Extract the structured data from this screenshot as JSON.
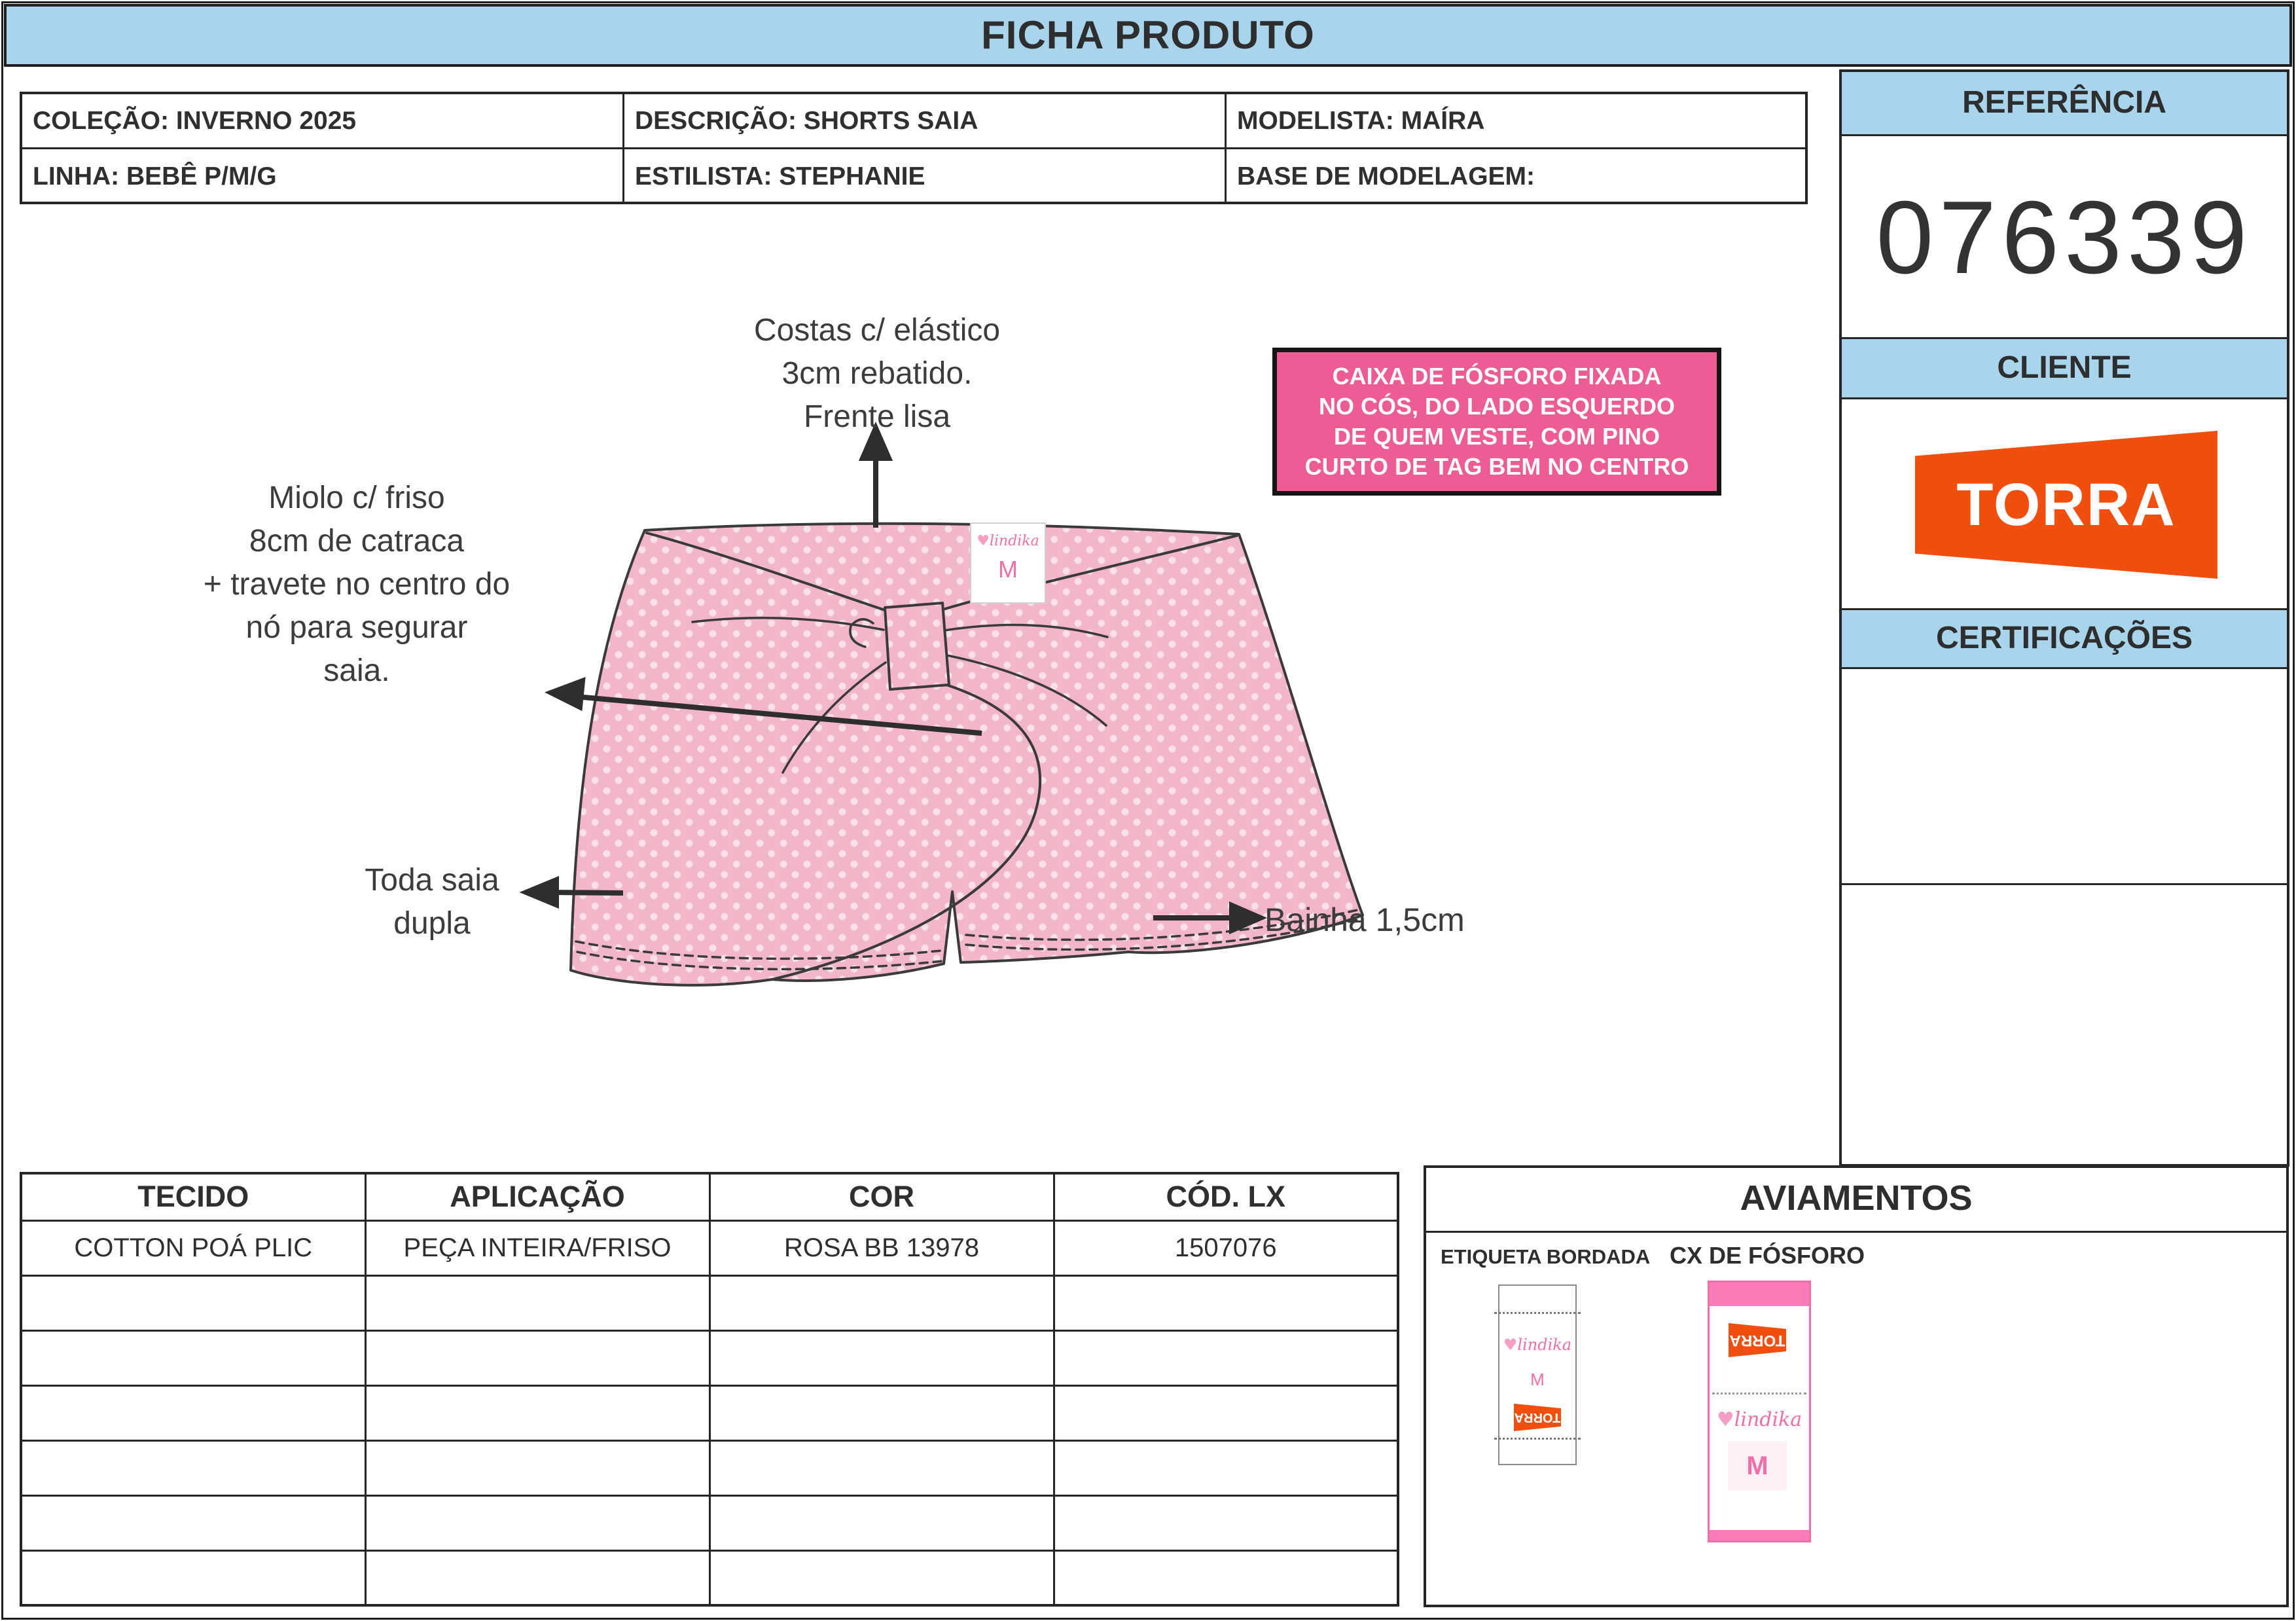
{
  "header": {
    "title": "FICHA PRODUTO"
  },
  "info_table": {
    "colecao": "COLEÇÃO: INVERNO 2025",
    "descricao": "DESCRIÇÃO: SHORTS SAIA",
    "modelista": "MODELISTA: MAÍRA",
    "linha": "LINHA: BEBÊ P/M/G",
    "estilista": "ESTILISTA: STEPHANIE",
    "base_modelagem": "BASE DE MODELAGEM:"
  },
  "sidebar": {
    "referencia_label": "REFERÊNCIA",
    "referencia_value": "076339",
    "cliente_label": "CLIENTE",
    "cliente_logo": "TORRA",
    "certificacoes_label": "CERTIFICAÇÕES"
  },
  "annotations": {
    "costas_lines": [
      "Costas c/ elástico",
      "3cm rebatido.",
      "Frente lisa"
    ],
    "miolo_lines": [
      "Miolo c/ friso",
      "8cm de catraca",
      "+ travete no centro do",
      "nó para segurar",
      "saia."
    ],
    "toda_saia_lines": [
      "Toda saia",
      "dupla"
    ],
    "bainha": "Bainha 1,5cm",
    "note_lines": [
      "CAIXA DE FÓSFORO FIXADA",
      "NO CÓS, DO LADO ESQUERDO",
      "DE QUEM VESTE, COM PINO",
      "CURTO DE TAG BEM NO CENTRO"
    ]
  },
  "garment_label": {
    "brand": "lindika",
    "heart": "♥",
    "size": "M"
  },
  "materials_table": {
    "headers": [
      "TECIDO",
      "APLICAÇÃO",
      "COR",
      "CÓD. LX"
    ],
    "row1": [
      "COTTON POÁ PLIC",
      "PEÇA INTEIRA/FRISO",
      "ROSA BB 13978",
      "1507076"
    ],
    "empty_rows": 6
  },
  "aviamentos": {
    "title": "AVIAMENTOS",
    "etiqueta_label": "ETIQUETA BORDADA",
    "caixa_label": "CX DE FÓSFORO",
    "tag_brand": "lindika",
    "tag_heart": "♥",
    "tag_size": "M",
    "tag_logo": "TORRA"
  },
  "colors": {
    "section_blue": "#A8D4EC",
    "note_pink": "#EE5C94",
    "garment_pink": "#F2B6C8",
    "garment_dot": "#F9DFE9",
    "brand_orange": "#F24E0D",
    "lindika_pink": "#F06FA8",
    "tag_band_pink": "#FB7DB8",
    "line_dark": "#3A3A3A"
  }
}
